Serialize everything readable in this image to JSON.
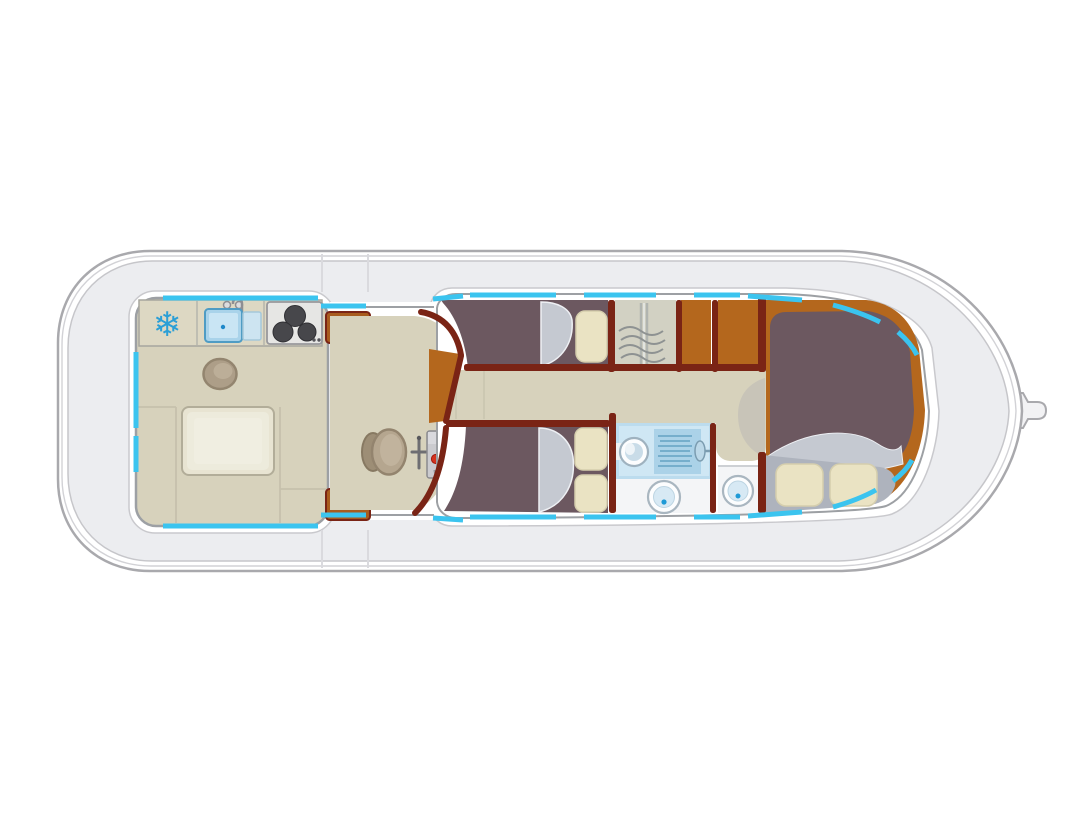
{
  "page": {
    "background": "#ffffff",
    "kind": "boat-floorplan-diagram"
  },
  "diagram": {
    "type": "houseboat deck plan, top view, horizontal hull with pointed tip at right and rounded end at left",
    "rooms": [
      {
        "id": "galley-saloon",
        "fixtures": [
          "refrigerator",
          "sink-with-faucet",
          "stove-three-burners",
          "round-stool",
          "dining-table",
          "u-bench-seating",
          "entry-step-top",
          "entry-step-bottom"
        ]
      },
      {
        "id": "helm-station",
        "fixtures": [
          "steering-wheel",
          "throttle-lever",
          "control-panel",
          "red-indicator",
          "green-indicator",
          "companionway-steps"
        ]
      },
      {
        "id": "upper-center-cabin",
        "fixtures": [
          "single-berth",
          "pillow",
          "bedding"
        ]
      },
      {
        "id": "wardrobe",
        "fixtures": [
          "rail",
          "coat-hangers"
        ]
      },
      {
        "id": "storage-cabinets",
        "fixtures": []
      },
      {
        "id": "lower-center-cabin",
        "fixtures": [
          "double-berth",
          "pillow",
          "pillow",
          "bedding"
        ]
      },
      {
        "id": "shower-room",
        "fixtures": [
          "washbasin",
          "shower-head-with-spray",
          "toilet"
        ]
      },
      {
        "id": "wc-room",
        "fixtures": [
          "toilet"
        ]
      },
      {
        "id": "hallway",
        "fixtures": [
          "step-crescent"
        ]
      },
      {
        "id": "right-cabin",
        "fixtures": [
          "double-bed",
          "blanket",
          "pillow",
          "pillow"
        ]
      }
    ],
    "icons": [
      "snowflake-icon",
      "faucet-icon",
      "burner-icons",
      "hanger-icons",
      "shower-spray-icon",
      "steering-wheel-icon",
      "toilet-icon",
      "washbasin-icon",
      "hull-tip-fitting"
    ]
  },
  "icons": {
    "snowflake_glyph": "❄"
  },
  "colors": {
    "background": "#ffffff",
    "hull_line": "#a9a9ad",
    "hull_mid": "#d2d2d6",
    "deck": "#ecedf0",
    "deck_line": "#c6c6ca",
    "halo_line": "#c9c9cd",
    "wall_gray": "#9da0a4",
    "window_cyan": "#3bc4ef",
    "floor_beige": "#d7d2bc",
    "counter_beige": "#ddd8c3",
    "wall_maroon": "#7a2415",
    "step_brown": "#a85c1e",
    "cabinet_orange": "#b4671d",
    "mattress_mauve": "#6c5860",
    "bedding_silver": "#c5c9d1",
    "bed_base": "#aeb3bd",
    "pillow_cream": "#eae3c3",
    "pillow_edge": "#d5cead",
    "wardrobe_fill": "#d2d1c3",
    "hanger_gray": "#8e9292",
    "table_fill": "#e8e4d2",
    "stool_tan": "#ad9e88",
    "stove_panel": "#e6e6e4",
    "burner_dark": "#47474b",
    "sink_blue": "#a9d3ea",
    "shower_blue": "#bcdcee",
    "shower_panel": "#cfe7f4",
    "spray_blue": "#6fa9c9",
    "floor_white": "#f4f5f7",
    "accent_blue": "#1f9ad6",
    "panel_gray": "#cbcbcf",
    "indicator_red": "#d4331f",
    "indicator_green": "#63ae68",
    "snowflake_blue": "#2b9fd6",
    "crescent_gray": "#c8c4b8",
    "seam_line": "#c6c1ac"
  }
}
